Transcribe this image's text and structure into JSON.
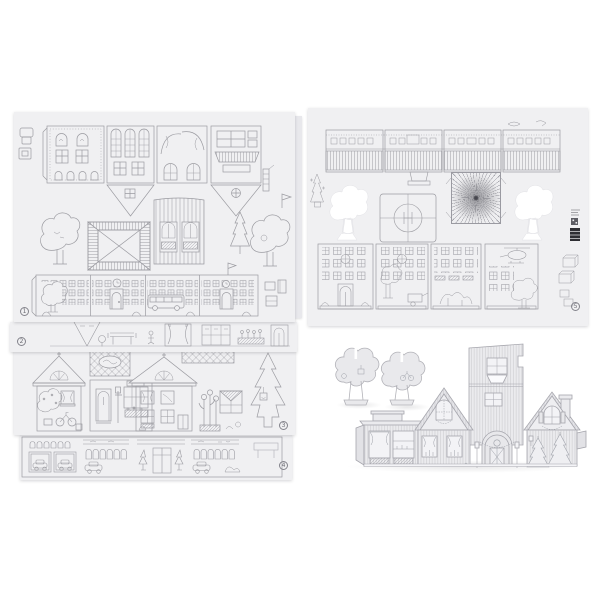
{
  "photo": {
    "type": "product-photo-papercraft-village-kit",
    "background_color": "#ffffff",
    "sheet_color": "#f0f0f2",
    "line_color": "#9b9ba1",
    "model_fill_color": "#ebebee"
  },
  "sheets": [
    {
      "number": "1",
      "name": "sheet-town-facades-roof-trees"
    },
    {
      "number": "2",
      "name": "sheet-interior-strip"
    },
    {
      "number": "3",
      "name": "sheet-gabled-houses-fir"
    },
    {
      "number": "4",
      "name": "sheet-garages-shops-strip"
    },
    {
      "number": "5",
      "name": "sheet-market-stalls-helipad-tower"
    }
  ],
  "assembled_model": {
    "name": "assembled-paper-village",
    "parts": [
      "slot-tree",
      "slot-tree",
      "flat-roof-shop",
      "gabled-house",
      "tower",
      "arched-entrance",
      "gabled-house-with-chimney"
    ]
  }
}
